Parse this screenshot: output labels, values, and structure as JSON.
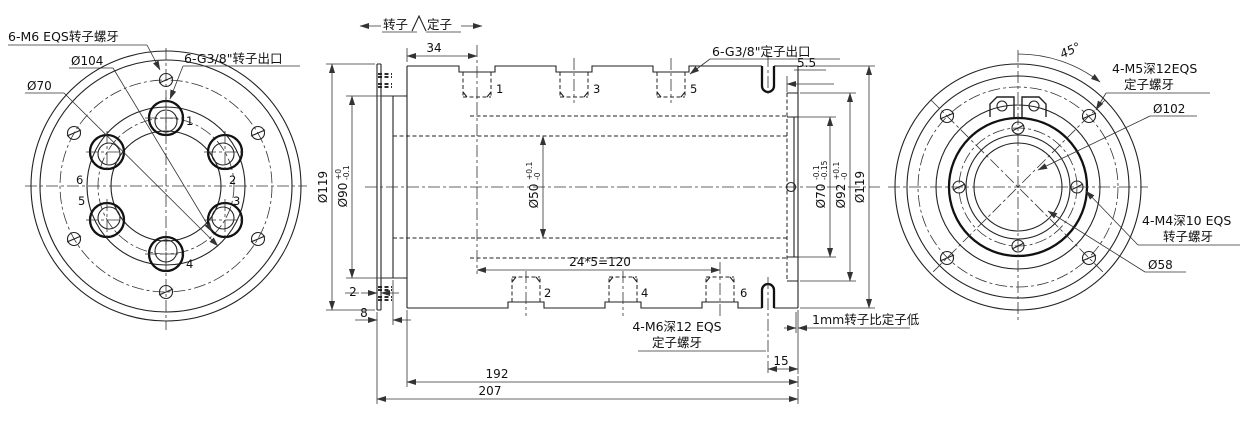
{
  "drawing": {
    "split_marker": {
      "rotor": "转子",
      "stator": "定子"
    },
    "left_view": {
      "note_m6": "6-M6 EQS转子螺牙",
      "dia_104": "Ø104",
      "dia_70": "Ø70",
      "note_g38": "6-G3/8\"转子出口",
      "ports": [
        "1",
        "2",
        "3",
        "4",
        "5",
        "6"
      ]
    },
    "section": {
      "dim_34": "34",
      "dim_5_5": "5.5",
      "dim_2": "2",
      "dim_8": "8",
      "dim_pitch": "24*5=120",
      "dim_15": "15",
      "dim_192": "192",
      "dim_207": "207",
      "dia_119_left": "Ø119",
      "dia_119_right": "Ø119",
      "dia_90": {
        "v": "Ø90",
        "up": "+0",
        "dn": "-0.1"
      },
      "dia_50": {
        "v": "Ø50",
        "up": "+0.1",
        "dn": "-0"
      },
      "dia_70": {
        "v": "Ø70",
        "up": "-0.1",
        "dn": "-0.15"
      },
      "dia_92": {
        "v": "Ø92",
        "up": "+0.1",
        "dn": "-0"
      },
      "note_stator_outlet": "6-G3/8\"定子出口",
      "note_m6_line1": "4-M6深12 EQS",
      "note_m6_line2": "定子螺牙",
      "note_offset": "1mm转子比定子低",
      "holes_top": [
        "1",
        "3",
        "5"
      ],
      "holes_bottom": [
        "2",
        "4",
        "6"
      ]
    },
    "right_view": {
      "angle_45": "45°",
      "note_m5_line1": "4-M5深12EQS",
      "note_m5_line2": "定子螺牙",
      "dia_102": "Ø102",
      "note_m4_line1": "4-M4深10 EQS",
      "note_m4_line2": "转子螺牙",
      "dia_58": "Ø58"
    }
  }
}
